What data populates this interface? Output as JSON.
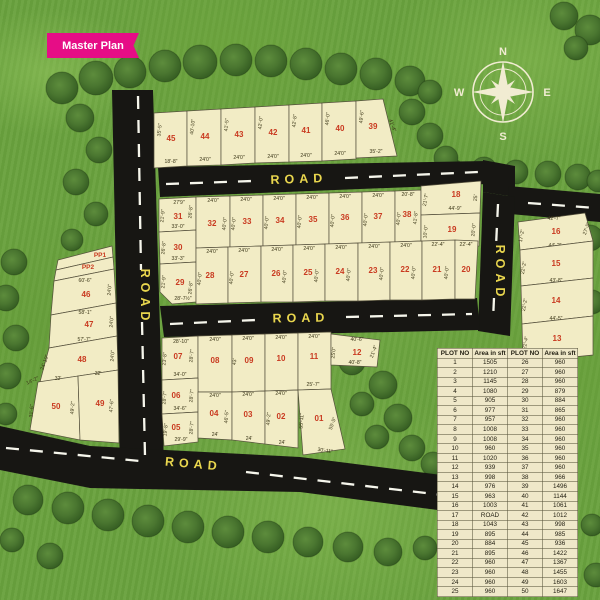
{
  "ribbon": {
    "label": "Master Plan"
  },
  "compass": {
    "n": "N",
    "e": "E",
    "s": "S",
    "w": "W"
  },
  "road_label": "ROAD",
  "road_labels": [
    {
      "x": 299,
      "y": 183,
      "r": -2
    },
    {
      "x": 141,
      "y": 297,
      "r": 90
    },
    {
      "x": 496,
      "y": 273,
      "r": 90
    },
    {
      "x": 301,
      "y": 322,
      "r": -1
    },
    {
      "x": 193,
      "y": 468,
      "r": 5
    }
  ],
  "plots": [
    {
      "n": "45",
      "p": "154,113 187,111 187,166 154,168",
      "l": [
        171,
        141
      ],
      "d": [
        [
          "35'-5\"",
          161,
          130,
          -84
        ],
        [
          "18'-8\"",
          171,
          163,
          0
        ]
      ]
    },
    {
      "n": "44",
      "p": "187,111 221,109 221,165 187,166",
      "l": [
        205,
        139
      ],
      "d": [
        [
          "40'-10\"",
          194,
          127,
          -84
        ],
        [
          "24'0\"",
          205,
          161,
          0
        ]
      ]
    },
    {
      "n": "43",
      "p": "221,109 255,107 255,163 221,165",
      "l": [
        239,
        137
      ],
      "d": [
        [
          "41'-5\"",
          228,
          125,
          -84
        ],
        [
          "24'0\"",
          239,
          159,
          0
        ]
      ]
    },
    {
      "n": "42",
      "p": "255,107 289,105 289,162 255,163",
      "l": [
        273,
        135
      ],
      "d": [
        [
          "42'-0\"",
          262,
          123,
          -84
        ],
        [
          "24'0\"",
          273,
          158,
          0
        ]
      ]
    },
    {
      "n": "41",
      "p": "289,105 322,103 322,161 289,162",
      "l": [
        306,
        133
      ],
      "d": [
        [
          "42'-8\"",
          296,
          121,
          -84
        ],
        [
          "24'0\"",
          306,
          157,
          0
        ]
      ]
    },
    {
      "n": "40",
      "p": "322,103 356,101 356,159 322,161",
      "l": [
        340,
        131
      ],
      "d": [
        [
          "46'-0\"",
          329,
          119,
          -84
        ],
        [
          "24'0\"",
          340,
          155,
          0
        ]
      ]
    },
    {
      "n": "39",
      "p": "356,101 383,99 397,156 356,158",
      "l": [
        373,
        129
      ],
      "d": [
        [
          "49'-6\"",
          363,
          117,
          -84
        ],
        [
          "41'-4\"",
          391,
          126,
          70
        ],
        [
          "35'-2\"",
          376,
          153,
          0
        ]
      ]
    },
    {
      "n": "31",
      "p": "159,199 196,197 196,230 159,232",
      "l": [
        178,
        219
      ],
      "d": [
        [
          "27'9\"",
          179,
          204,
          0
        ],
        [
          "21'-9\"",
          164,
          216,
          -84
        ],
        [
          "26'-8\"",
          192,
          212,
          -84
        ],
        [
          "33'-0\"",
          178,
          228,
          0
        ]
      ]
    },
    {
      "n": "30",
      "p": "159,232 196,230 196,262 160,264",
      "l": [
        178,
        250
      ],
      "d": [
        [
          "26'-8\"",
          165,
          248,
          -84
        ],
        [
          "33'-3\"",
          178,
          260,
          0
        ]
      ]
    },
    {
      "n": "29",
      "p": "160,264 196,262 196,302 172,304 160,292",
      "l": [
        180,
        285
      ],
      "d": [
        [
          "21'-9\"",
          165,
          282,
          -84
        ],
        [
          "26'-8\"",
          192,
          288,
          -84
        ],
        [
          "28'-7½\"",
          183,
          300,
          0
        ]
      ]
    },
    {
      "n": "32",
      "p": "196,197 230,196 230,247 196,248",
      "l": [
        212,
        226
      ],
      "d": [
        [
          "24'0\"",
          213,
          202,
          0
        ],
        [
          "40'-0\"",
          226,
          224,
          -84
        ]
      ]
    },
    {
      "n": "33",
      "p": "230,196 263,195 263,246 230,247",
      "l": [
        247,
        224
      ],
      "d": [
        [
          "24'0\"",
          246,
          201,
          0
        ],
        [
          "40'-0\"",
          235,
          224,
          -84
        ]
      ]
    },
    {
      "n": "34",
      "p": "263,195 296,194 296,245 263,246",
      "l": [
        280,
        223
      ],
      "d": [
        [
          "24'0\"",
          279,
          200,
          0
        ],
        [
          "40'-0\"",
          268,
          223,
          -84
        ]
      ]
    },
    {
      "n": "35",
      "p": "296,194 329,193 329,244 296,245",
      "l": [
        313,
        222
      ],
      "d": [
        [
          "24'0\"",
          312,
          199,
          0
        ],
        [
          "40'-0\"",
          301,
          222,
          -84
        ]
      ]
    },
    {
      "n": "36",
      "p": "329,193 362,192 362,243 329,244",
      "l": [
        345,
        220
      ],
      "d": [
        [
          "24'0\"",
          345,
          198,
          0
        ],
        [
          "40'-0\"",
          334,
          221,
          -84
        ]
      ]
    },
    {
      "n": "37",
      "p": "362,192 395,191 395,242 362,243",
      "l": [
        378,
        219
      ],
      "d": [
        [
          "24'0\"",
          378,
          197,
          0
        ],
        [
          "40'-0\"",
          367,
          220,
          -84
        ]
      ]
    },
    {
      "n": "38",
      "p": "395,191 421,190 421,241 395,242",
      "l": [
        407,
        217
      ],
      "d": [
        [
          "20'-8\"",
          408,
          196,
          0
        ],
        [
          "40'-0\"",
          400,
          219,
          -84
        ],
        [
          "41'-8\"",
          417,
          218,
          -84
        ]
      ]
    },
    {
      "n": "18",
      "p": "421,186 481,181 480,213 421,215",
      "l": [
        456,
        197
      ],
      "d": [
        [
          "21'-7\"",
          427,
          200,
          -80
        ],
        [
          "44'-9\"",
          455,
          210,
          0
        ],
        [
          "25'",
          477,
          198,
          -84
        ]
      ]
    },
    {
      "n": "19",
      "p": "421,215 480,213 479,246 421,248",
      "l": [
        452,
        232
      ],
      "d": [
        [
          "10'-0\"",
          427,
          232,
          -84
        ],
        [
          "20'-0\"",
          475,
          230,
          -84
        ]
      ]
    },
    {
      "n": "28",
      "p": "196,248 228,247 228,303 196,304",
      "l": [
        210,
        278
      ],
      "d": [
        [
          "24'0\"",
          212,
          253,
          0
        ],
        [
          "40'-0\"",
          201,
          279,
          -84
        ]
      ]
    },
    {
      "n": "27",
      "p": "228,247 261,246 261,302 228,303",
      "l": [
        244,
        277
      ],
      "d": [
        [
          "24'0\"",
          244,
          252,
          0
        ],
        [
          "40'-0\"",
          233,
          278,
          -84
        ]
      ]
    },
    {
      "n": "26",
      "p": "261,246 293,245 293,302 261,302",
      "l": [
        276,
        276
      ],
      "d": [
        [
          "24'0\"",
          277,
          251,
          0
        ],
        [
          "40'-0\"",
          286,
          277,
          -84
        ]
      ]
    },
    {
      "n": "25",
      "p": "293,245 325,244 325,301 293,302",
      "l": [
        308,
        275
      ],
      "d": [
        [
          "24'0\"",
          309,
          250,
          0
        ],
        [
          "40'-0\"",
          318,
          276,
          -84
        ]
      ]
    },
    {
      "n": "24",
      "p": "325,244 358,243 358,301 325,301",
      "l": [
        340,
        274
      ],
      "d": [
        [
          "24'0\"",
          341,
          249,
          0
        ],
        [
          "40'-0\"",
          350,
          275,
          -84
        ]
      ]
    },
    {
      "n": "23",
      "p": "358,243 390,242 390,300 358,301",
      "l": [
        373,
        273
      ],
      "d": [
        [
          "24'0\"",
          374,
          248,
          0
        ],
        [
          "40'-0\"",
          383,
          274,
          -84
        ]
      ]
    },
    {
      "n": "22",
      "p": "390,242 422,241 422,300 390,300",
      "l": [
        405,
        272
      ],
      "d": [
        [
          "24'0\"",
          406,
          247,
          0
        ],
        [
          "40'-0\"",
          415,
          273,
          -84
        ]
      ]
    },
    {
      "n": "21",
      "p": "422,241 455,240 455,299 422,300",
      "l": [
        437,
        272
      ],
      "d": [
        [
          "22'-4\"",
          438,
          246,
          0
        ],
        [
          "40'-0\"",
          448,
          273,
          -84
        ]
      ]
    },
    {
      "n": "20",
      "p": "455,240 478,241 475,299 455,299",
      "l": [
        466,
        272
      ],
      "d": [
        [
          "22'-4\"",
          466,
          246,
          0
        ]
      ]
    },
    {
      "n": "16",
      "p": "518,222 585,213 593,241 520,250",
      "l": [
        556,
        234
      ],
      "d": [
        [
          "42'-7\"",
          554,
          220,
          0
        ],
        [
          "17'-2\"",
          523,
          236,
          -80
        ],
        [
          "27'-5\"",
          588,
          229,
          -70
        ],
        [
          "44'-2\"",
          555,
          247,
          0
        ]
      ]
    },
    {
      "n": "15",
      "p": "520,250 593,241 593,278 521,286",
      "l": [
        556,
        266
      ],
      "d": [
        [
          "22'-2\"",
          525,
          268,
          -80
        ],
        [
          "43'-8\"",
          556,
          282,
          0
        ]
      ]
    },
    {
      "n": "14",
      "p": "521,286 593,278 593,316 522,324",
      "l": [
        556,
        303
      ],
      "d": [
        [
          "22'-2\"",
          526,
          305,
          -80
        ],
        [
          "44'-5\"",
          556,
          320,
          0
        ]
      ]
    },
    {
      "n": "13",
      "p": "522,324 593,316 593,355 523,362",
      "l": [
        557,
        341
      ],
      "d": [
        [
          "22'-4\"",
          527,
          343,
          -80
        ],
        [
          "45'-2\"",
          557,
          357,
          0
        ]
      ]
    },
    {
      "n": "PP1",
      "p": "58,260 112,246 113,257 56,270",
      "l": [
        100,
        257
      ],
      "fs": 6.5,
      "d": []
    },
    {
      "n": "PP2",
      "p": "56,270 113,257 114,269 54,281",
      "l": [
        88,
        269
      ],
      "fs": 6.5,
      "d": []
    },
    {
      "n": "46",
      "p": "54,281 114,269 116,303 51,315",
      "l": [
        86,
        297
      ],
      "d": [
        [
          "60'-6\"",
          85,
          282,
          0
        ],
        [
          "24'0\"",
          111,
          290,
          -86
        ]
      ]
    },
    {
      "n": "47",
      "p": "51,315 116,303 117,336 49,348",
      "l": [
        89,
        327
      ],
      "d": [
        [
          "58'-1\"",
          85,
          314,
          0
        ],
        [
          "24'0\"",
          113,
          322,
          -86
        ],
        [
          "57'-7\"",
          84,
          341,
          0
        ]
      ]
    },
    {
      "n": "48",
      "p": "49,348 117,336 118,370 40,382",
      "l": [
        82,
        362
      ],
      "d": [
        [
          "24'-10\"",
          46,
          363,
          -70
        ],
        [
          "24'0\"",
          114,
          356,
          -86
        ]
      ]
    },
    {
      "n": "50",
      "p": "38,382 78,376 80,440 30,430",
      "l": [
        56,
        409
      ],
      "d": [
        [
          "32'",
          58,
          380,
          0
        ],
        [
          "14'-2\"",
          33,
          382,
          -25
        ],
        [
          "31'-6\"",
          33,
          411,
          -86
        ],
        [
          "49'-2\"",
          74,
          408,
          -86
        ]
      ]
    },
    {
      "n": "49",
      "p": "78,376 118,370 119,443 80,440",
      "l": [
        100,
        406
      ],
      "d": [
        [
          "32'",
          98,
          375,
          0
        ],
        [
          "47'-6\"",
          113,
          406,
          -86
        ]
      ]
    },
    {
      "n": "07",
      "p": "162,338 198,336 198,378 162,380",
      "l": [
        178,
        359
      ],
      "d": [
        [
          "28'-10\"",
          181,
          343,
          0
        ],
        [
          "23'-8\"",
          166,
          359,
          -84
        ],
        [
          "28'-7\"",
          193,
          356,
          -84
        ],
        [
          "34'-0\"",
          180,
          376,
          0
        ]
      ]
    },
    {
      "n": "08",
      "p": "198,336 232,335 232,392 198,392",
      "l": [
        215,
        363
      ],
      "d": [
        [
          "24'0\"",
          215,
          341,
          0
        ]
      ]
    },
    {
      "n": "09",
      "p": "232,335 265,334 265,391 232,392",
      "l": [
        249,
        363
      ],
      "d": [
        [
          "24'0\"",
          248,
          340,
          0
        ],
        [
          "43'",
          236,
          362,
          -84
        ]
      ]
    },
    {
      "n": "10",
      "p": "265,334 298,333 298,390 265,391",
      "l": [
        281,
        361
      ],
      "d": [
        [
          "24'0\"",
          281,
          339,
          0
        ]
      ]
    },
    {
      "n": "11",
      "p": "298,333 331,332 331,389 298,390",
      "l": [
        314,
        359
      ],
      "d": [
        [
          "24'0\"",
          314,
          338,
          0
        ],
        [
          "25'-7\"",
          313,
          386,
          0
        ]
      ]
    },
    {
      "n": "12",
      "p": "331,334 380,340 377,367 331,365",
      "l": [
        357,
        355
      ],
      "d": [
        [
          "40'-6\"",
          357,
          341,
          0
        ],
        [
          "25'0\"",
          335,
          353,
          -84
        ],
        [
          "21'-4\"",
          375,
          352,
          -70
        ],
        [
          "40'-8\"",
          355,
          364,
          0
        ]
      ]
    },
    {
      "n": "06",
      "p": "162,380 198,378 198,412 162,414",
      "l": [
        176,
        398
      ],
      "d": [
        [
          "28'-7\"",
          166,
          398,
          -84
        ],
        [
          "28'-7\"",
          193,
          396,
          -84
        ],
        [
          "34'-6\"",
          180,
          410,
          0
        ]
      ]
    },
    {
      "n": "05",
      "p": "162,414 198,412 198,442 164,446",
      "l": [
        176,
        430
      ],
      "d": [
        [
          "19'-8\"",
          167,
          430,
          -84
        ],
        [
          "28'-7\"",
          193,
          428,
          -84
        ],
        [
          "29'-9\"",
          181,
          441,
          0
        ]
      ]
    },
    {
      "n": "04",
      "p": "198,392 232,392 232,440 198,438",
      "l": [
        214,
        416
      ],
      "d": [
        [
          "24'0\"",
          215,
          397,
          0
        ],
        [
          "46'-5\"",
          228,
          417,
          -86
        ],
        [
          "24'",
          215,
          436,
          0
        ]
      ]
    },
    {
      "n": "03",
      "p": "232,392 265,391 265,444 232,440",
      "l": [
        248,
        417
      ],
      "d": [
        [
          "24'0\"",
          248,
          396,
          0
        ],
        [
          "24'",
          249,
          440,
          0
        ]
      ]
    },
    {
      "n": "02",
      "p": "265,391 298,390 298,448 265,444",
      "l": [
        281,
        419
      ],
      "d": [
        [
          "24'0\"",
          281,
          395,
          0
        ],
        [
          "49'-2\"",
          270,
          419,
          -86
        ],
        [
          "24'",
          282,
          444,
          0
        ]
      ]
    },
    {
      "n": "01",
      "p": "298,390 331,389 345,449 303,455",
      "l": [
        319,
        421
      ],
      "d": [
        [
          "55'-11\"",
          303,
          421,
          -86
        ],
        [
          "55'-5\"",
          334,
          424,
          -70
        ],
        [
          "30'-11\"",
          325,
          452,
          8
        ]
      ]
    }
  ],
  "table": {
    "headers": [
      "PLOT NO",
      "Area in sft",
      "PLOT NO",
      "Area in sft"
    ],
    "rows": [
      [
        "1",
        "1505",
        "26",
        "960"
      ],
      [
        "2",
        "1210",
        "27",
        "960"
      ],
      [
        "3",
        "1145",
        "28",
        "960"
      ],
      [
        "4",
        "1080",
        "29",
        "879"
      ],
      [
        "5",
        "905",
        "30",
        "884"
      ],
      [
        "6",
        "977",
        "31",
        "865"
      ],
      [
        "7",
        "957",
        "32",
        "960"
      ],
      [
        "8",
        "1008",
        "33",
        "960"
      ],
      [
        "9",
        "1008",
        "34",
        "960"
      ],
      [
        "10",
        "960",
        "35",
        "960"
      ],
      [
        "11",
        "1020",
        "36",
        "960"
      ],
      [
        "12",
        "939",
        "37",
        "960"
      ],
      [
        "13",
        "998",
        "38",
        "966"
      ],
      [
        "14",
        "976",
        "39",
        "1496"
      ],
      [
        "15",
        "963",
        "40",
        "1144"
      ],
      [
        "16",
        "1003",
        "41",
        "1061"
      ],
      [
        "17",
        "ROAD",
        "42",
        "1012"
      ],
      [
        "18",
        "1043",
        "43",
        "998"
      ],
      [
        "19",
        "895",
        "44",
        "985"
      ],
      [
        "20",
        "884",
        "45",
        "936"
      ],
      [
        "21",
        "895",
        "46",
        "1422"
      ],
      [
        "22",
        "960",
        "47",
        "1367"
      ],
      [
        "23",
        "960",
        "48",
        "1455"
      ],
      [
        "24",
        "960",
        "49",
        "1603"
      ],
      [
        "25",
        "960",
        "50",
        "1647"
      ]
    ]
  }
}
